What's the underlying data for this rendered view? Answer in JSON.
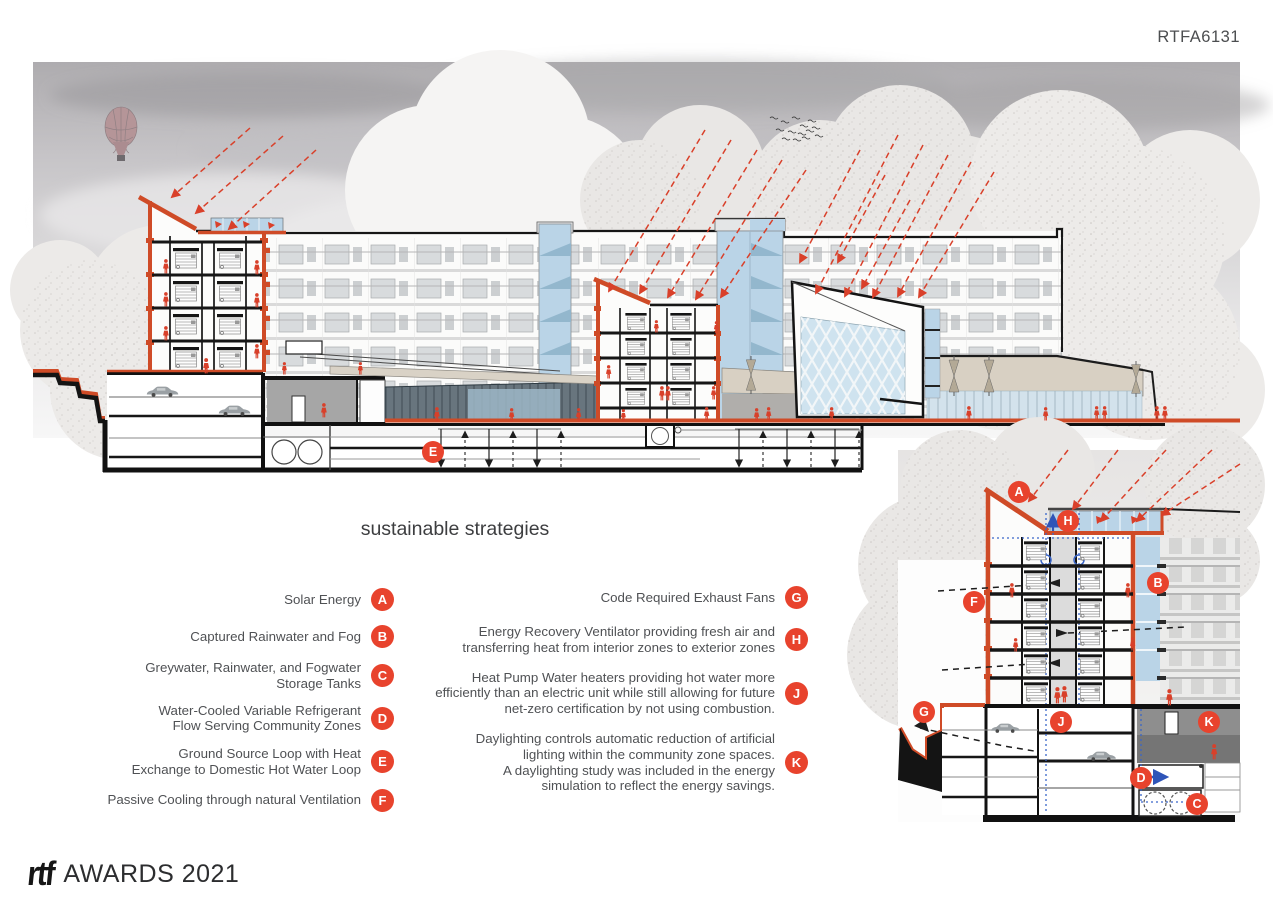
{
  "header": {
    "project_code": "RTFA6131"
  },
  "legend": {
    "heading": "sustainable strategies",
    "left": [
      {
        "letter": "A",
        "text": "Solar Energy"
      },
      {
        "letter": "B",
        "text": "Captured Rainwater and Fog"
      },
      {
        "letter": "C",
        "text": "Greywater, Rainwater, and Fogwater\nStorage Tanks"
      },
      {
        "letter": "D",
        "text": "Water-Cooled Variable Refrigerant\nFlow Serving Community Zones"
      },
      {
        "letter": "E",
        "text": "Ground Source Loop with Heat\nExchange to Domestic Hot Water Loop"
      },
      {
        "letter": "F",
        "text": "Passive Cooling through natural Ventilation"
      }
    ],
    "right": [
      {
        "letter": "G",
        "text": "Code Required Exhaust Fans"
      },
      {
        "letter": "H",
        "text": "Energy Recovery Ventilator providing fresh air and\ntransferring heat from interior zones to exterior zones"
      },
      {
        "letter": "J",
        "text": "Heat Pump Water heaters providing hot water more\nefficiently than an electric unit while still allowing for future\nnet-zero certification by not using combustion."
      },
      {
        "letter": "K",
        "text": "Daylighting controls automatic reduction of artificial\nlighting within the community zone spaces.\nA daylighting study was included in the energy\nsimulation to reflect the energy savings."
      }
    ]
  },
  "markers": {
    "main": [
      {
        "letter": "E"
      }
    ],
    "detail": [
      {
        "letter": "A"
      },
      {
        "letter": "H"
      },
      {
        "letter": "B"
      },
      {
        "letter": "F"
      },
      {
        "letter": "G"
      },
      {
        "letter": "J"
      },
      {
        "letter": "K"
      },
      {
        "letter": "D"
      },
      {
        "letter": "C"
      }
    ]
  },
  "footer": {
    "logo_text": "rtf",
    "awards_text": "AWARDS 2021"
  },
  "colors": {
    "badge_red": "#e8432d",
    "section_cut_orange": "#cf4b27",
    "sun_ray_red": "#d9402a",
    "glazing_blue": "#bad4e7",
    "diagram_blue": "#2f55b8",
    "text_grey": "#4f5154"
  }
}
